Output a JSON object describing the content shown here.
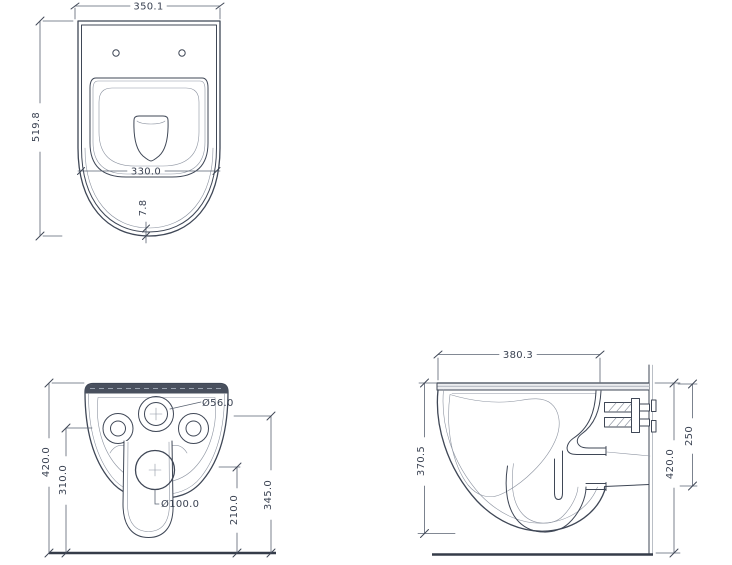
{
  "drawing": {
    "colors": {
      "line": "#3f4756",
      "light_line": "#8d94a1",
      "band": "#49505e",
      "background": "#ffffff"
    },
    "views": {
      "top_view": {
        "name": "top view",
        "dimensions": {
          "overall_width": "350.1",
          "overall_depth": "519.8",
          "bowl_width": "330.0",
          "rim_thickness": "7.8"
        }
      },
      "rear_view": {
        "name": "rear view",
        "dimensions": {
          "overall_height": "420.0",
          "side_hole_height": "310.0",
          "inlet_diameter": "Ø56.0",
          "outlet_diameter": "Ø100.0",
          "outlet_height": "210.0",
          "inlet_height": "345.0"
        }
      },
      "side_view": {
        "name": "side view",
        "dimensions": {
          "overall_depth": "380.3",
          "body_height": "370.5",
          "overall_height": "420.0",
          "top_to_bracket": "250"
        }
      }
    }
  }
}
